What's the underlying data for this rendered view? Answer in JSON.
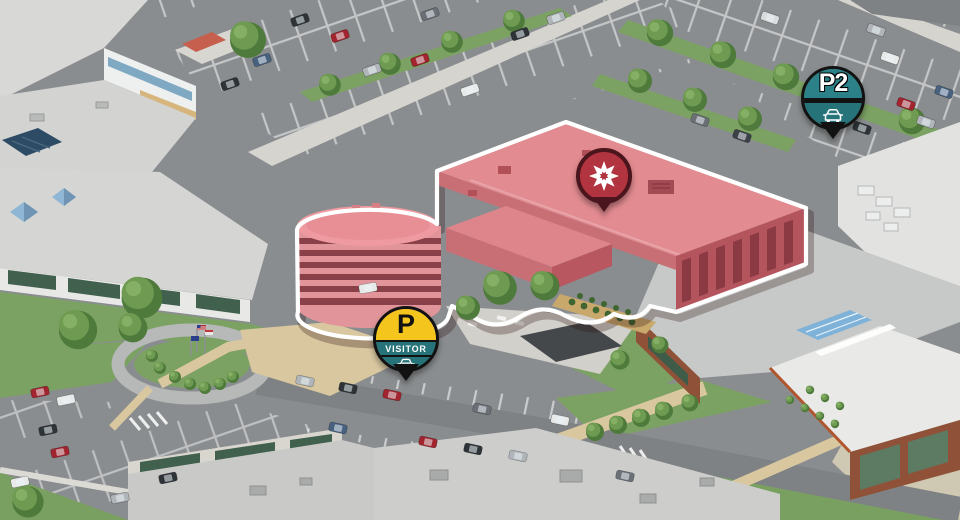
{
  "map": {
    "markers": {
      "destination": {
        "icon": "flower-logo-icon"
      },
      "parking_p2": {
        "label": "P2",
        "icon": "car-icon"
      },
      "parking_visitor": {
        "p_label": "P",
        "label": "VISITOR",
        "icon": "car-icon"
      }
    },
    "colors": {
      "pin_teal": "#26747a",
      "pin_teal_light": "#2b8187",
      "pin_yellow": "#f4c51d",
      "pin_dark": "#121212",
      "destination_fill": "#b23440",
      "destination_rim": "#4a151c",
      "highlight_building": "#e28b90",
      "highlight_outline": "#ffffff"
    }
  }
}
